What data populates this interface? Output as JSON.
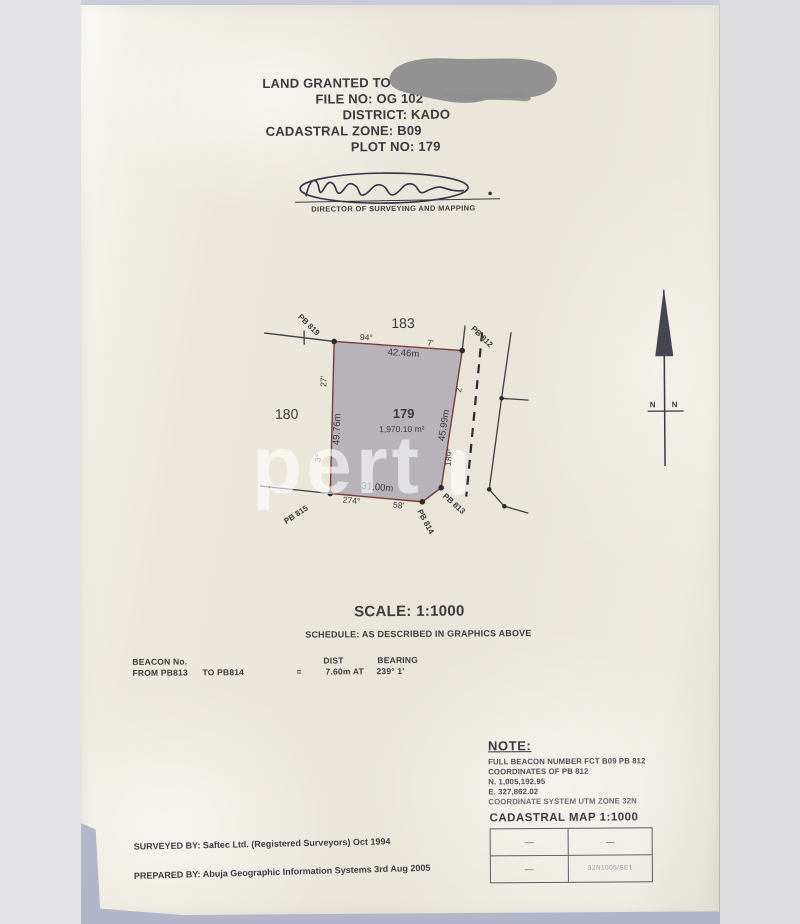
{
  "header": {
    "granted": "LAND GRANTED TO",
    "file_no": "FILE NO: OG 102",
    "district": "DISTRICT: KADO",
    "zone": "CADASTRAL ZONE: B09",
    "plot_no": "PLOT NO: 179"
  },
  "signature": {
    "title": "DIRECTOR OF SURVEYING AND MAPPING"
  },
  "diagram": {
    "adjacent_top": "183",
    "adjacent_left": "180",
    "plot_number": "179",
    "plot_area": "1,970.10 m²",
    "north1": "N",
    "north2": "N",
    "beacons": [
      {
        "id": "PB 819"
      },
      {
        "id": "PB 812"
      },
      {
        "id": "PB 813"
      },
      {
        "id": "PB 814"
      },
      {
        "id": "PB 815"
      }
    ],
    "edges": [
      {
        "from": "PB 819",
        "to": "PB 812",
        "distance": "42.46m",
        "deg": "94°",
        "min": "7'"
      },
      {
        "from": "PB 812",
        "to": "PB 813",
        "distance": "45.99m",
        "deg": "189°",
        "min": "2'"
      },
      {
        "from": "PB 814",
        "to": "PB 815",
        "distance": "31.00m",
        "deg": "274°",
        "min": "58'"
      },
      {
        "from": "PB 815",
        "to": "PB 819",
        "distance": "49.76m",
        "deg": "3°",
        "min": "27'"
      }
    ]
  },
  "scale": {
    "text": "SCALE: 1:1000"
  },
  "schedule": {
    "text": "SCHEDULE: AS DESCRIBED IN GRAPHICS ABOVE"
  },
  "beacon_table": {
    "col_beacon": "BEACON No.",
    "col_dist": "DIST",
    "col_bearing": "BEARING",
    "from": "FROM  PB813",
    "to": "TO  PB814",
    "equals": "=",
    "dist": "7.60m  AT",
    "bearing": "239°  1'"
  },
  "note": {
    "title": "NOTE:",
    "lines": [
      "FULL BEACON NUMBER FCT B09 PB 812",
      "COORDINATES OF PB 812",
      "N. 1,005,192.95",
      "E. 327,862.02",
      "COORDINATE SYSTEM UTM ZONE 32N"
    ]
  },
  "cadastral_map": {
    "title": "CADASTRAL MAP 1:1000",
    "r1c1": "—",
    "r1c2": "—",
    "r2c1": "—",
    "r2c2": "32N1005/SE1"
  },
  "footer": {
    "surveyed_by": "SURVEYED BY: Saftec Ltd. (Registered Surveyors)  Oct 1994",
    "prepared_by": "PREPARED BY: Abuja Geographic Information Systems  3rd Aug 2005"
  },
  "watermark": {
    "text": "pert"
  },
  "colors": {
    "plot_fill": "#b2afb6",
    "plot_border": "#7a3b3f",
    "paper": "#ebe7dc",
    "backdrop_blue": "#b6b9cc",
    "ink": "#35353a",
    "redaction_gray": "#8e8e91"
  }
}
